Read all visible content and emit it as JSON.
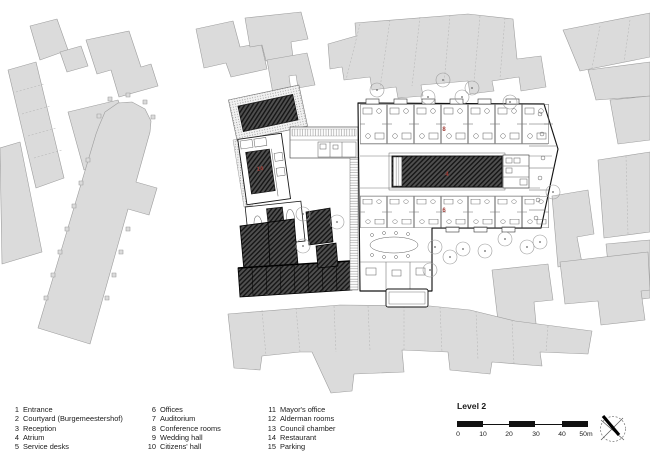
{
  "plan": {
    "level_label": "Level 2",
    "scale": {
      "ticks": [
        "0",
        "10",
        "20",
        "30",
        "40",
        "50m"
      ]
    },
    "room_labels": {
      "restaurant": "14",
      "conference": "8",
      "atrium": "4",
      "offices": "6"
    },
    "north_icon": "compass-north-arrow"
  },
  "legend": {
    "columns": [
      {
        "items": [
          {
            "num": "1",
            "label": "Entrance"
          },
          {
            "num": "2",
            "label": "Courtyard (Burgemeestershof)"
          },
          {
            "num": "3",
            "label": "Reception"
          },
          {
            "num": "4",
            "label": "Atrium"
          },
          {
            "num": "5",
            "label": "Service desks"
          }
        ]
      },
      {
        "items": [
          {
            "num": "6",
            "label": "Offices"
          },
          {
            "num": "7",
            "label": "Auditorium"
          },
          {
            "num": "8",
            "label": "Conference rooms"
          },
          {
            "num": "9",
            "label": "Wedding hall"
          },
          {
            "num": "10",
            "label": "Citizens' hall"
          }
        ]
      },
      {
        "items": [
          {
            "num": "11",
            "label": "Mayor's office"
          },
          {
            "num": "12",
            "label": "Alderman rooms"
          },
          {
            "num": "13",
            "label": "Council chamber"
          },
          {
            "num": "14",
            "label": "Restaurant"
          },
          {
            "num": "15",
            "label": "Parking"
          }
        ]
      }
    ]
  },
  "colors": {
    "context_fill": "#dbdbdb",
    "context_stroke": "#9e9e9e",
    "accent_red": "#a23b35",
    "hatch_dark": "#4f4f4f",
    "ink": "#141414"
  }
}
